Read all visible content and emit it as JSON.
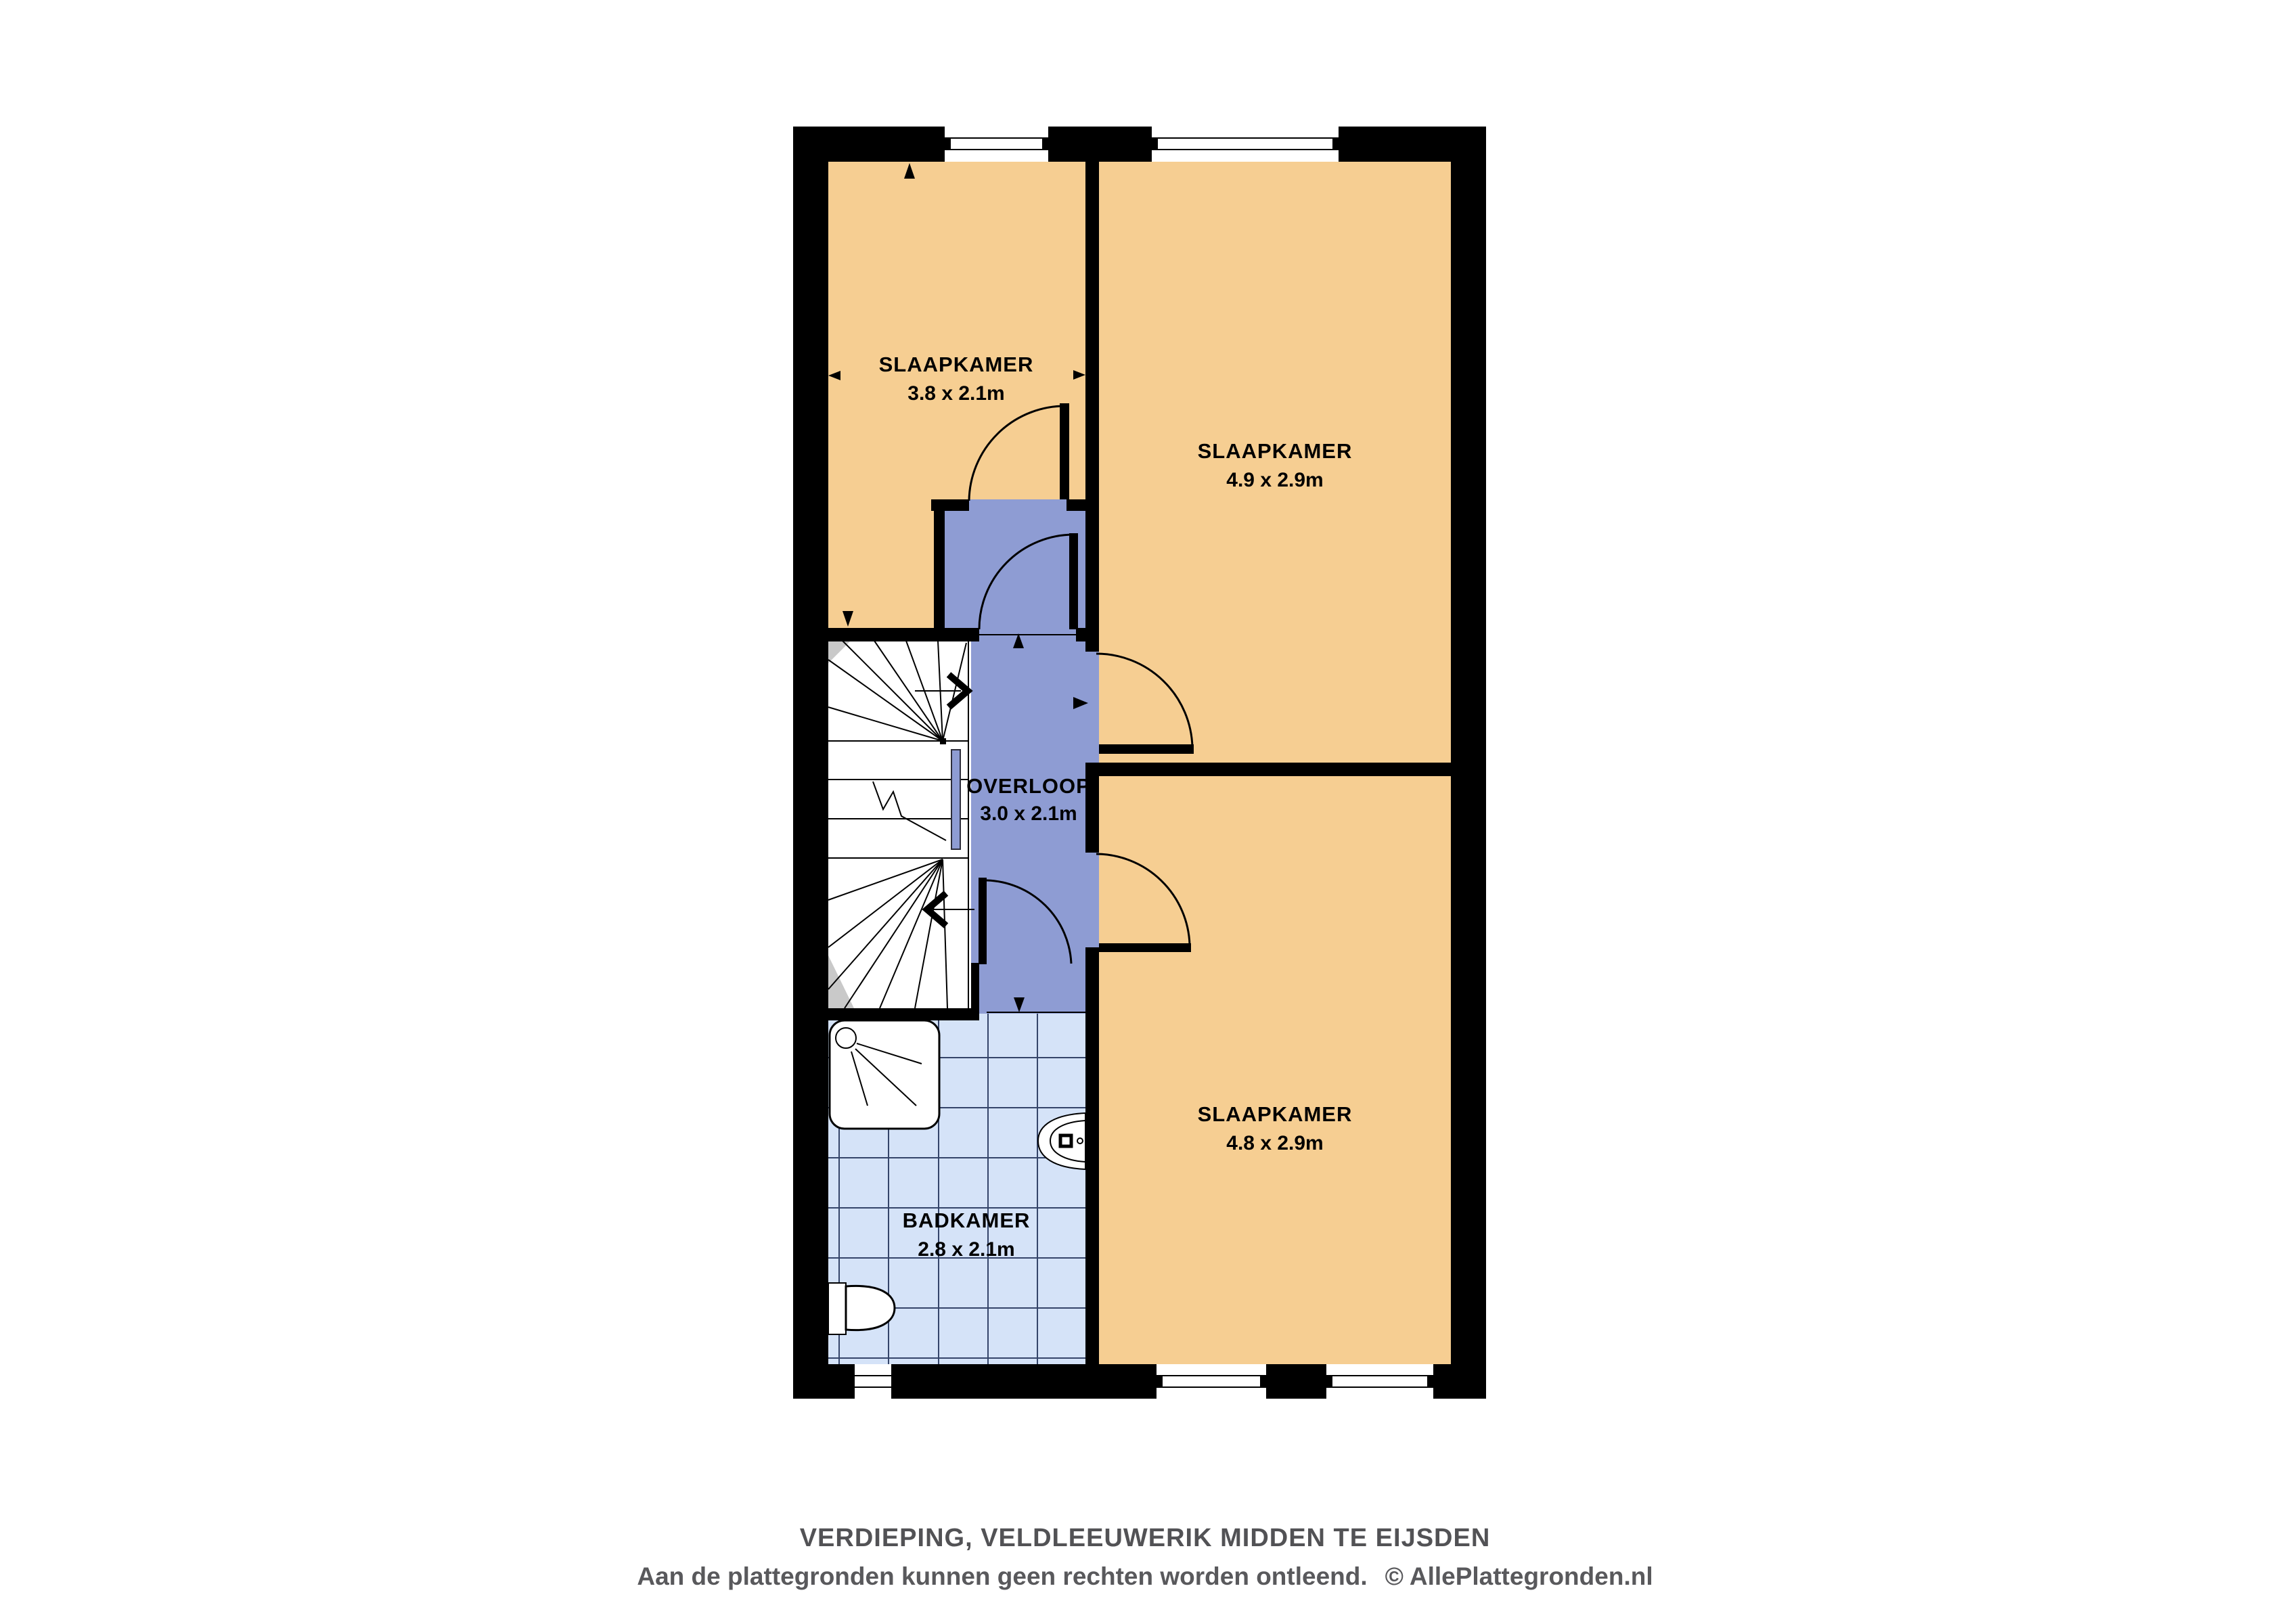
{
  "floorplan": {
    "rooms": [
      {
        "id": "bedroom-top-left",
        "name": "SLAAPKAMER",
        "dims": "3.8 x 2.1m"
      },
      {
        "id": "bedroom-top-right",
        "name": "SLAAPKAMER",
        "dims": "4.9 x 2.9m"
      },
      {
        "id": "landing",
        "name": "OVERLOOP",
        "dims": "3.0 x 2.1m"
      },
      {
        "id": "bedroom-bottom-right",
        "name": "SLAAPKAMER",
        "dims": "4.8 x 2.9m"
      },
      {
        "id": "bathroom",
        "name": "BADKAMER",
        "dims": "2.8 x 2.1m"
      }
    ],
    "colors": {
      "wall": "#000000",
      "bedroom_fill": "#f6ce92",
      "landing_fill": "#8e9cd3",
      "bathroom_tile": "#d5e3f8",
      "tile_line": "#35456a",
      "stair_gray": "#c9c9c9"
    }
  },
  "footer": {
    "title": "VERDIEPING, VELDLEEUWERIK MIDDEN TE EIJSDEN",
    "disclaimer": "Aan de plattegronden kunnen geen rechten worden ontleend.",
    "copyright": "©",
    "brand": "AllePlattegronden.nl"
  }
}
